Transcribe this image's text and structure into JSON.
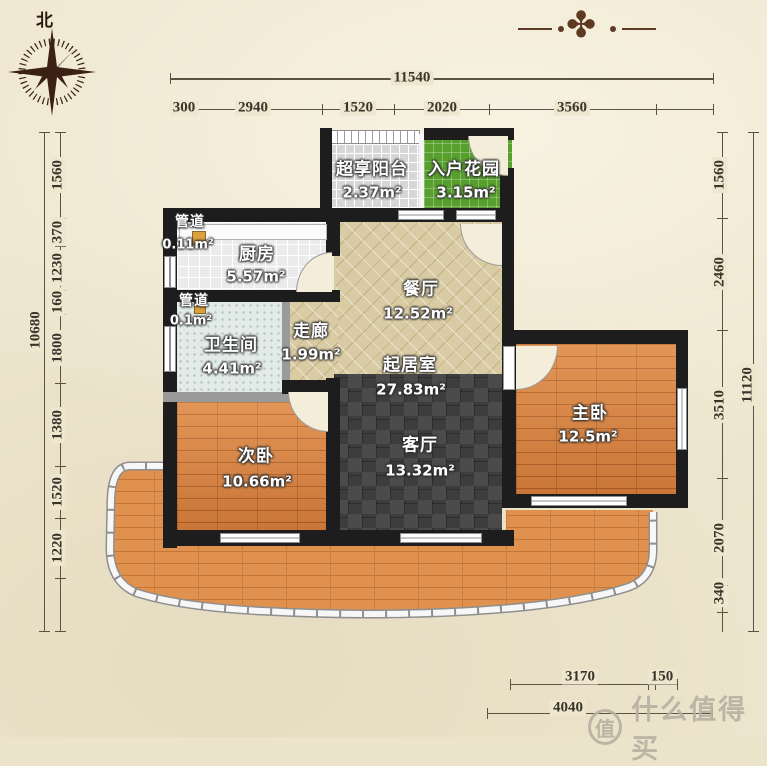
{
  "compass": {
    "north_label": "北"
  },
  "dims": {
    "top_total": "11540",
    "top_segments": [
      "300",
      "2940",
      "1520",
      "2020",
      "3560"
    ],
    "left_total": "10680",
    "left_segments": [
      "1560",
      "370",
      "1230",
      "160",
      "1800",
      "1380",
      "1520",
      "1220"
    ],
    "right_total": "11120",
    "right_segments": [
      "1560",
      "2460",
      "3510",
      "2070",
      "340"
    ],
    "bottom_segments": [
      "3170",
      "150"
    ],
    "bottom_total": "4040"
  },
  "rooms": {
    "balcony": {
      "name": "超享阳台",
      "area": "2.37m²"
    },
    "garden": {
      "name": "入户花园",
      "area": "3.15m²"
    },
    "duct_top": {
      "name": "管道",
      "area": "0.11m²"
    },
    "kitchen": {
      "name": "厨房",
      "area": "5.57m²"
    },
    "duct_mid": {
      "name": "管道",
      "area": "0.1m²"
    },
    "bathroom": {
      "name": "卫生间",
      "area": "4.41m²"
    },
    "corridor": {
      "name": "走廊",
      "area": "1.99m²"
    },
    "dining": {
      "name": "餐厅",
      "area": "12.52m²"
    },
    "living_suite": {
      "name": "起居室",
      "area": "27.83m²"
    },
    "living": {
      "name": "客厅",
      "area": "13.32m²"
    },
    "master": {
      "name": "主卧",
      "area": "12.5m²"
    },
    "second": {
      "name": "次卧",
      "area": "10.66m²"
    }
  },
  "watermark": {
    "logo": "值",
    "brand": "什么值得买"
  },
  "colors": {
    "background": "#eee6cf",
    "wall": "#1d1d1d",
    "wood_floor": "#d8803e",
    "terrace_floor": "#e0914d",
    "garden_green": "#57a02d",
    "dining_beige": "#d9cba3",
    "carpet_dark": "#3d3d3d",
    "dimension_text": "#3a352a",
    "ornament_brown": "#5d3b22",
    "watermark_grey": "#b9b1a2"
  },
  "ornament_glyph": "✤"
}
